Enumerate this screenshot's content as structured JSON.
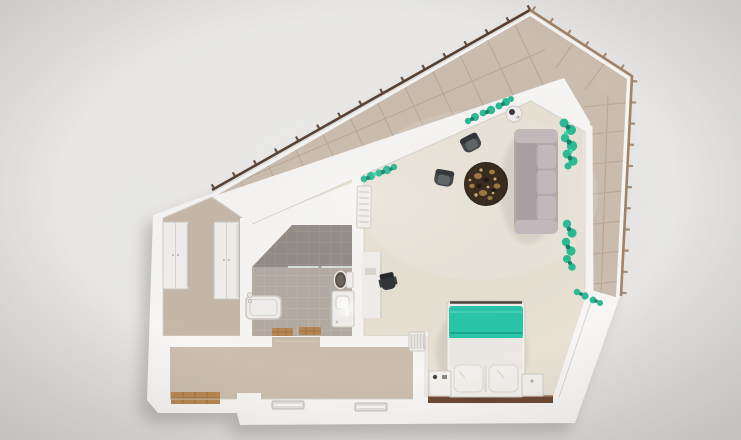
{
  "meta": {
    "title": "Top-down 3D floor plan render of a studio apartment",
    "style": "photorealistic cutaway dollhouse view, no visible text"
  },
  "scene": {
    "rooms": [
      {
        "name": "balcony",
        "features": [
          "beige tiled floor",
          "metal railing with posts wrapping two sides",
          "pointed tip at lower right"
        ]
      },
      {
        "name": "living-room",
        "furniture": [
          "three-seat sofa",
          "armchair",
          "armchair",
          "round dark patterned rug",
          "round side table with lamp",
          "desk",
          "office chair",
          "wall-mounted ac-radiator",
          "plants on window sills"
        ]
      },
      {
        "name": "bedroom",
        "furniture": [
          "double bed with teal blanket and two pillows",
          "nightstand left",
          "nightstand right",
          "dark wood window sill"
        ]
      },
      {
        "name": "bathroom",
        "furniture": [
          "shower zone with glass screen",
          "toilet",
          "vanity with glowing mirror light",
          "bathtub with faucet",
          "wooden bath mat",
          "wooden bath mat"
        ]
      },
      {
        "name": "hallway",
        "furniture": [
          "wardrobe",
          "wardrobe"
        ]
      },
      {
        "name": "entry-corridor",
        "furniture": [
          "radiator",
          "wooden entry floor",
          "low window",
          "low window",
          "entry door block"
        ]
      }
    ],
    "plant_clusters": 5,
    "window_walls": "full-height glazing along the two balcony-facing diagonals"
  },
  "colors": {
    "bg_hi": "#efeeec",
    "bg_mid": "#e7e6e4",
    "bg_lo": "#d7d6d4",
    "shadow": "#8f8c88",
    "wall": "#f7f6f4",
    "balcony_tile": "#cbbdaf",
    "tile_grout": "#b4a492",
    "railing_dark": "#573f30",
    "railing_light": "#a18468",
    "carpet": "#e8e1d4",
    "hall_floor": "#c6b8a9",
    "corridor_floor": "#cbbeae",
    "bath_tile": "#b4aba3",
    "shower_tile": "#918a85",
    "glass": "#dfe5e6",
    "wood": "#b98851",
    "wood_dark": "#6e4a35",
    "sofa": "#b6aaae",
    "sofa_light": "#c5babd",
    "sofa_seat": "#ab9fa4",
    "chair": "#3f4346",
    "chair_light": "#5d6164",
    "dark_obj": "#2e3134",
    "rug": "#34271a",
    "rug_gold": "#b08343",
    "rug_light": "#dcbb80",
    "teal": "#29c6aa",
    "teal_dark": "#14967e",
    "teal_hi": "#5fd9c2",
    "plant": "#2bbb95",
    "plant_dark": "#15826a",
    "plant_light": "#45d6ae",
    "white_obj": "#f2f0ed",
    "obj_line": "#cfcac4",
    "duvet": "#ebe8e3",
    "pillow": "#f1efeb",
    "window_glass": "#e3e1df"
  }
}
